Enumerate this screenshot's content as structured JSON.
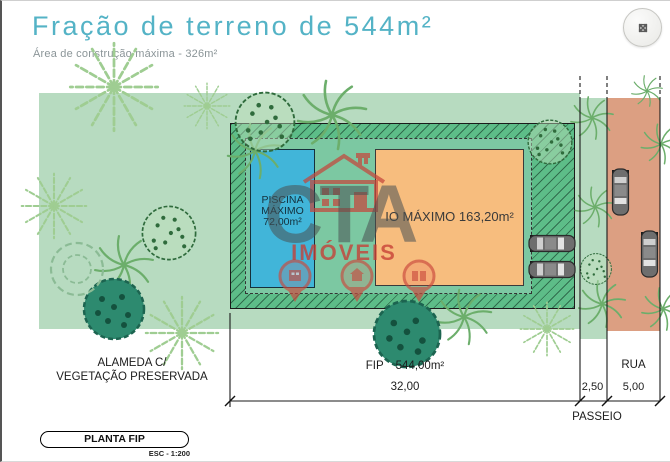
{
  "header": {
    "title": "Fração de terreno de 544m²",
    "subtitle": "Área de construção máxima - 326m²"
  },
  "plan": {
    "pool": {
      "label_lines": [
        "PISCINA",
        "MÁXIMO",
        "72,00m²"
      ]
    },
    "building": {
      "label": "IO MÁXIMO 163,20m²"
    },
    "annotations": {
      "alameda_line1": "ALAMEDA C/",
      "alameda_line2": "VEGETAÇÃO PRESERVADA",
      "fip": "FIP",
      "fip_area": "544,00m²",
      "dim_lot": "32,00",
      "dim_sidewalk": "2,50",
      "dim_street": "5,00",
      "street": "RUA",
      "sidewalk": "PASSEIO"
    }
  },
  "legend": {
    "plan_name": "PLANTA FIP",
    "scale": "ESC - 1:200"
  },
  "watermark": {
    "brand": "CTA",
    "subtitle": "IMÓVEIS"
  },
  "icons": {
    "expand": "expand-arrows",
    "watermark_logo": "house",
    "watermark_markers": "map-pins"
  },
  "colors": {
    "accent_title": "#54b3c6",
    "vegetation": "#b7dbc0",
    "plot_green": "#5dbd88",
    "plot_inner_green": "#7cc8a2",
    "pool_blue": "#41b5d9",
    "building_orange": "#f7bd7e",
    "street_salmon": "#dc9f82",
    "watermark_red": "#c4473c"
  }
}
